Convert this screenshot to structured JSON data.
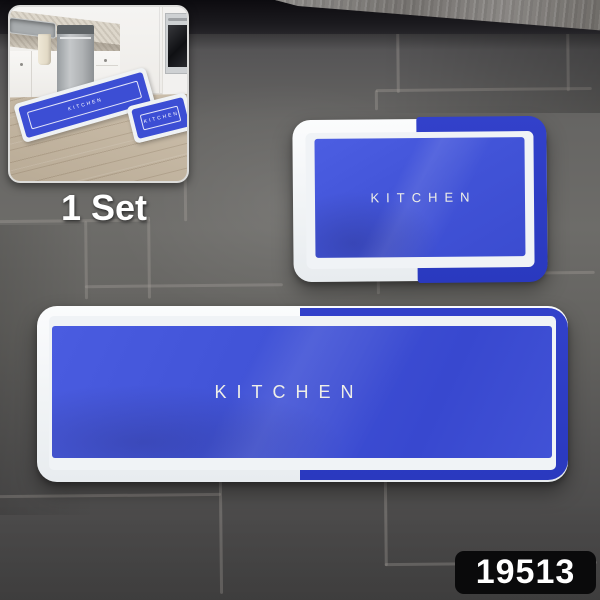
{
  "labels": {
    "set_label": "1 Set",
    "sku": "19513"
  },
  "mats": {
    "small": {
      "text": "KITCHEN"
    },
    "large": {
      "text": "KITCHEN"
    }
  },
  "inset": {
    "runner_mat_text": "KITCHEN",
    "small_mat_text": "KITCHEN"
  },
  "colors": {
    "mat_blue": "#4254d8",
    "mat_border_blue": "#2e3ec6",
    "mat_white": "#f1f4f6",
    "tile_gray": "#646360",
    "grout_gray": "#a29f99",
    "wood_floor_tan": "#cabda9",
    "sku_bg": "#0a0a0b",
    "sku_text": "#ffffff",
    "set_label_text": "#ffffff"
  }
}
